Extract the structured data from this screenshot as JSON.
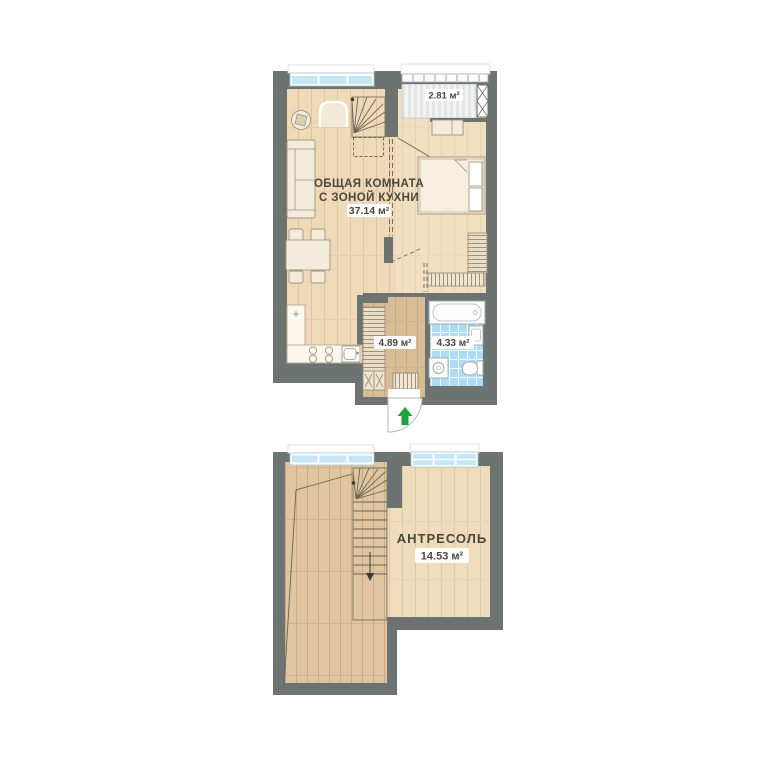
{
  "page": {
    "background": "#ffffff"
  },
  "plan": {
    "upper_floor": {
      "living_room": {
        "name_line1": "ОБЩАЯ КОМНАТА",
        "name_line2": "С ЗОНОЙ КУХНИ",
        "area": "37.14 м²"
      },
      "balcony": {
        "area": "2.81 м²"
      },
      "hallway": {
        "area": "4.89 м²"
      },
      "bathroom": {
        "area": "4.33 м²"
      }
    },
    "lower_floor": {
      "mezzanine": {
        "name": "АНТРЕСОЛЬ",
        "area": "14.53 м²"
      }
    },
    "colors": {
      "wall": "#6d7371",
      "floor_main": "#eed9b8",
      "floor_hall": "#d8bc96",
      "floor_lower": "#dfc6a0",
      "floor_mezzanine": "#eedcbc",
      "bathroom_tile": "#addcf4",
      "window_glass": "#c4e7f6",
      "balcony_floor": "#e9ecec",
      "entrance_arrow": "#1ca53b",
      "label_text": "#4b473c"
    }
  }
}
